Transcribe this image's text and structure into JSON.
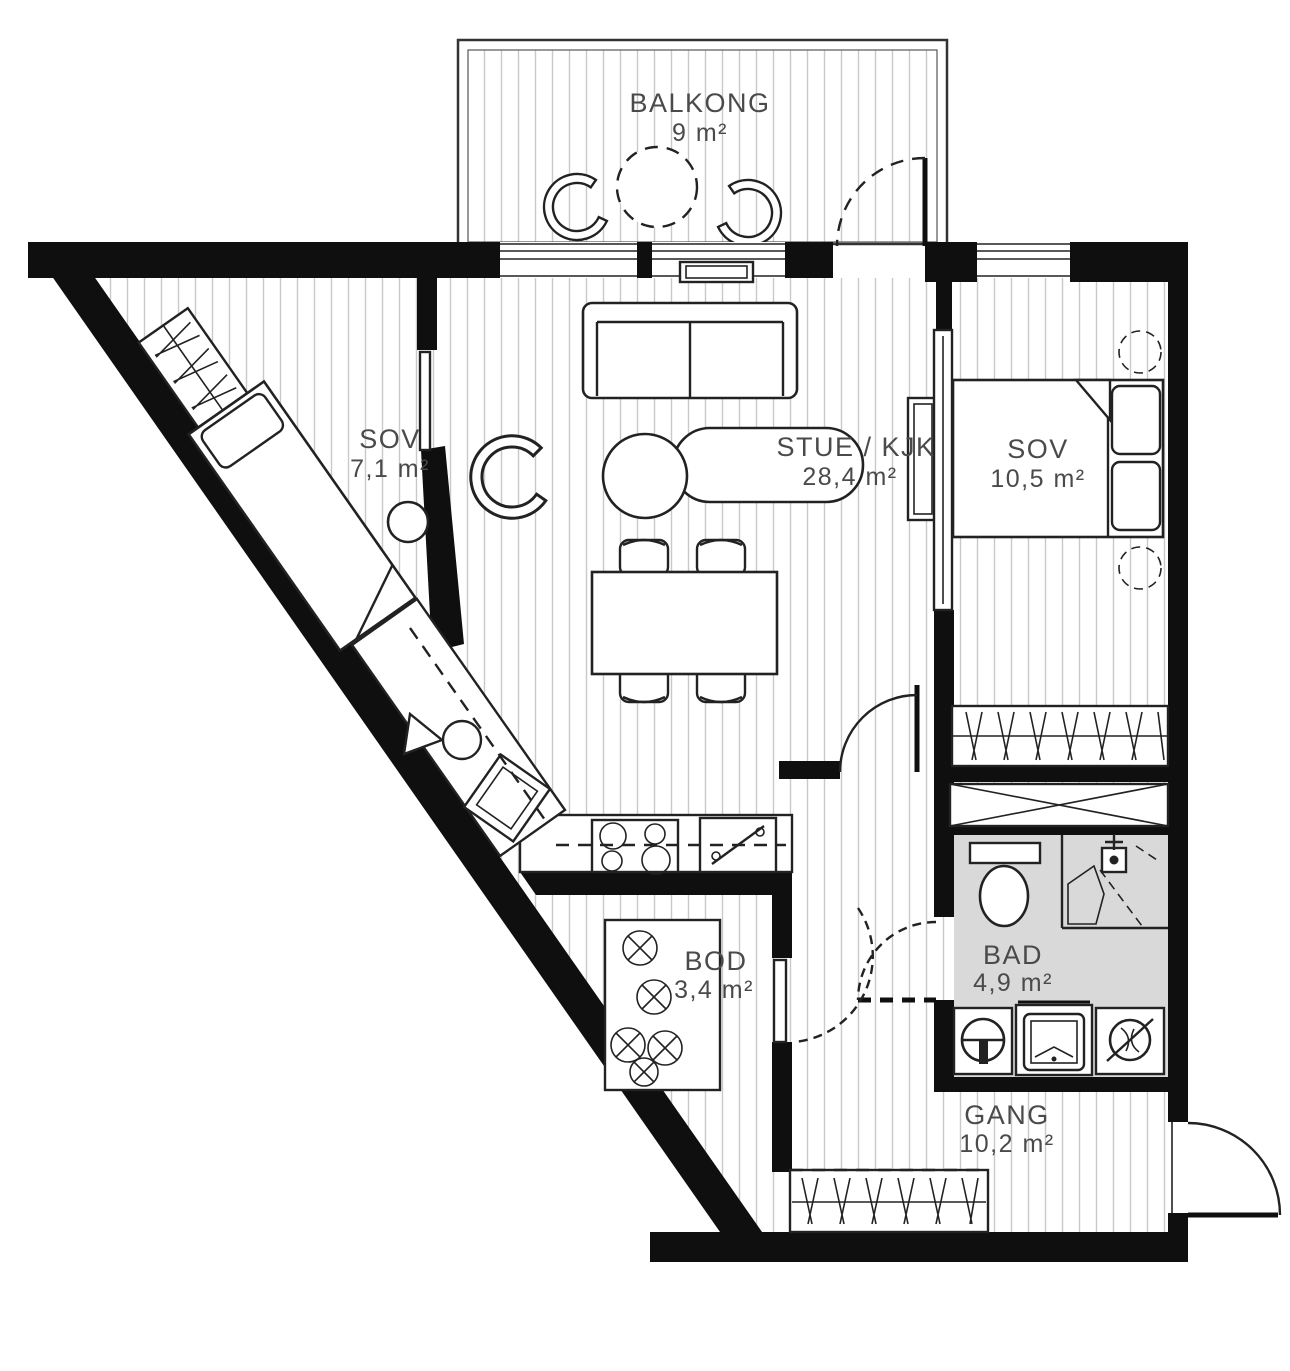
{
  "floorplan": {
    "type": "apartment-floor-plan",
    "rooms": [
      {
        "id": "balkong",
        "name": "BALKONG",
        "area": "9 m²"
      },
      {
        "id": "sov-left",
        "name": "SOV",
        "area": "7,1 m²"
      },
      {
        "id": "stue-kjk",
        "name": "STUE / KJK",
        "area": "28,4 m²"
      },
      {
        "id": "sov-right",
        "name": "SOV",
        "area": "10,5 m²"
      },
      {
        "id": "bod",
        "name": "BOD",
        "area": "3,4 m²"
      },
      {
        "id": "bad",
        "name": "BAD",
        "area": "4,9 m²"
      },
      {
        "id": "gang",
        "name": "GANG",
        "area": "10,2 m²"
      }
    ],
    "colors": {
      "wall": "#0f0f0f",
      "hatch": "#c9c9c9",
      "bathroomFill": "#d9d9d9",
      "line": "#222222",
      "label": "#4a4a4a",
      "background": "#ffffff"
    }
  }
}
